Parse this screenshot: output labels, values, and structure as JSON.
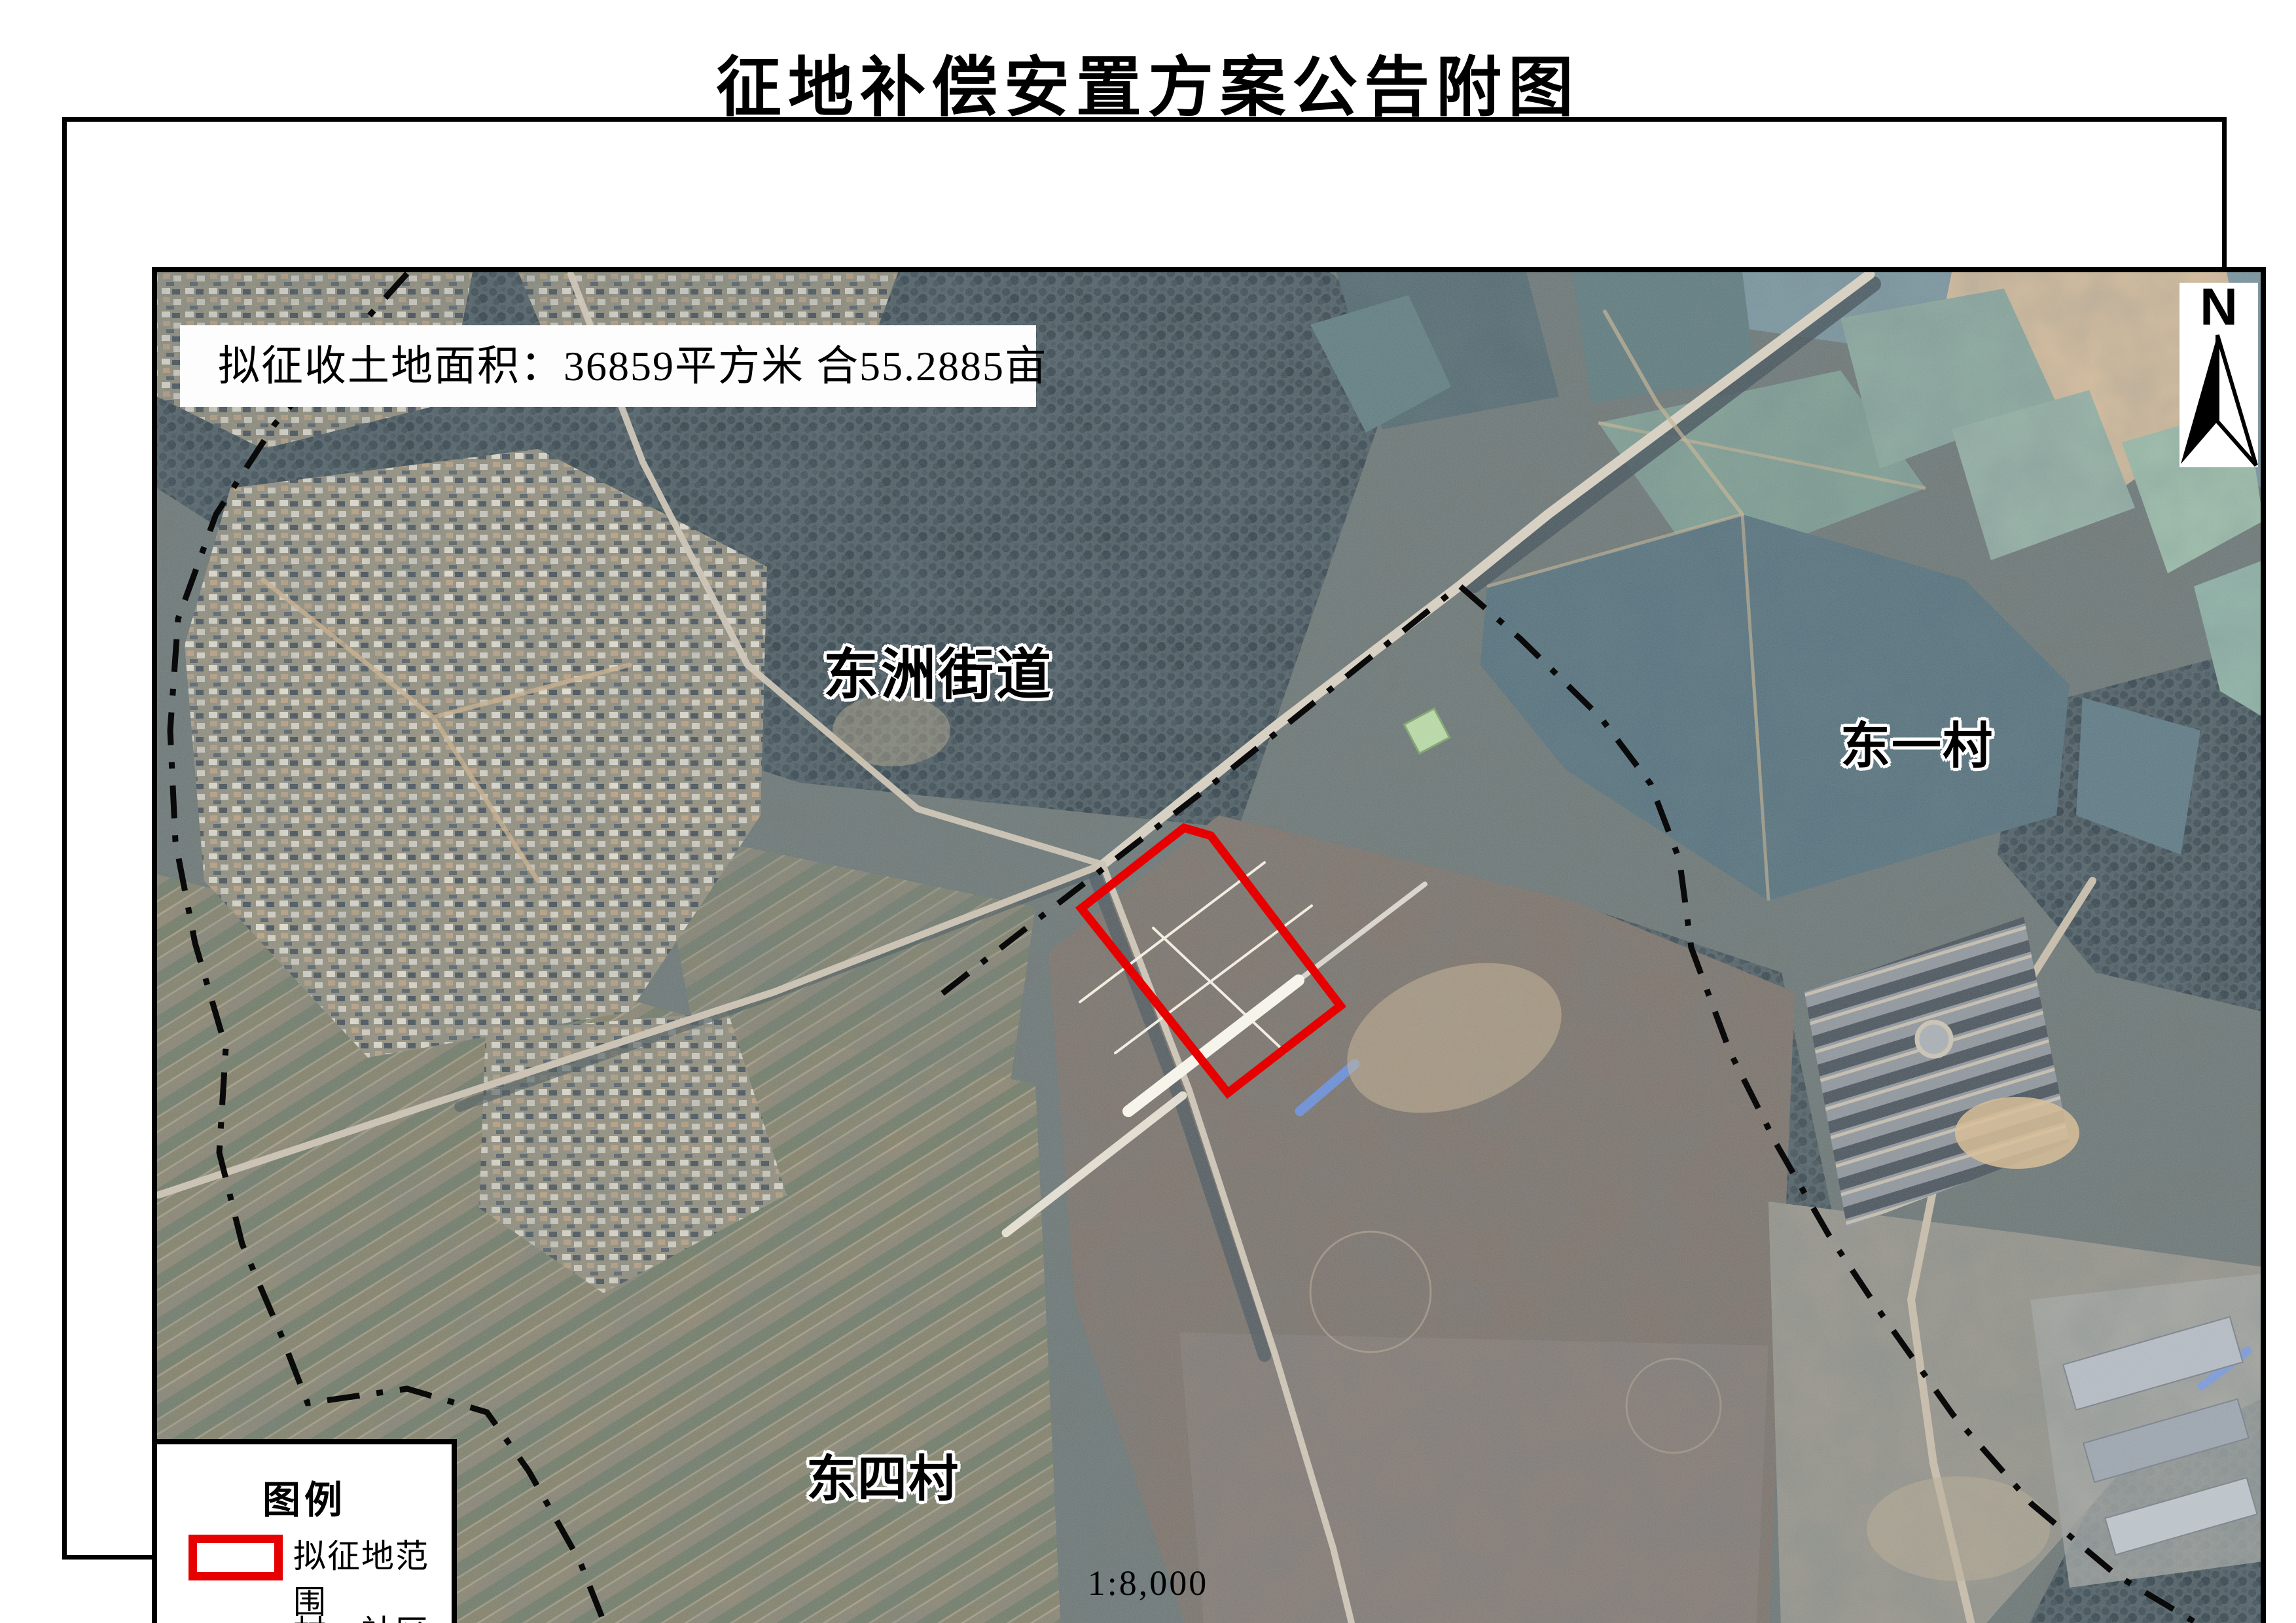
{
  "title": "征地补偿安置方案公告附图",
  "info_box": {
    "text": "拟征收土地面积：36859平方米  合55.2885亩"
  },
  "north_indicator": {
    "label": "N"
  },
  "map_labels": [
    {
      "id": "street",
      "text": "东洲街道"
    },
    {
      "id": "village-dongyi",
      "text": "东一村"
    },
    {
      "id": "village-dongsi",
      "text": "东四村"
    }
  ],
  "legend": {
    "title": "图例",
    "items": [
      {
        "label": "拟征地范围",
        "symbol": "red-rectangle",
        "color": "#e60000"
      },
      {
        "label": "村、社区界",
        "symbol": "dash-dot-line",
        "color": "#0a0a0a"
      }
    ]
  },
  "scale": {
    "text": "1:8,000"
  },
  "overlays": {
    "red_zone_color": "#e60000",
    "boundary_color": "#0a0a0a",
    "red_zone_points": "1550,1202 1707,1079 1748,1091 1946,1351 1774,1484",
    "boundary_left_path": "M 520 232 L 432 330 L 318 462 L 228 600 L 170 760 L 158 930 L 166 1100 L 196 1255 L 243 1415 L 233 1575 L 268 1715 L 328 1855 L 368 1958 L 520 1936 L 642 1972 L 706 2062 L 784 2200 L 836 2331",
    "boundary_right_path": "M 1338 1332 L 1452 1243 L 1742 1019 L 2128 709 L 2222 791 L 2344 911 L 2420 1012 L 2464 1128 L 2482 1262 L 2541 1421 L 2612 1562 L 2692 1701 L 2772 1821 L 2882 1976 L 3002 2112 L 3132 2221 L 3282 2311 L 3350 2331"
  }
}
